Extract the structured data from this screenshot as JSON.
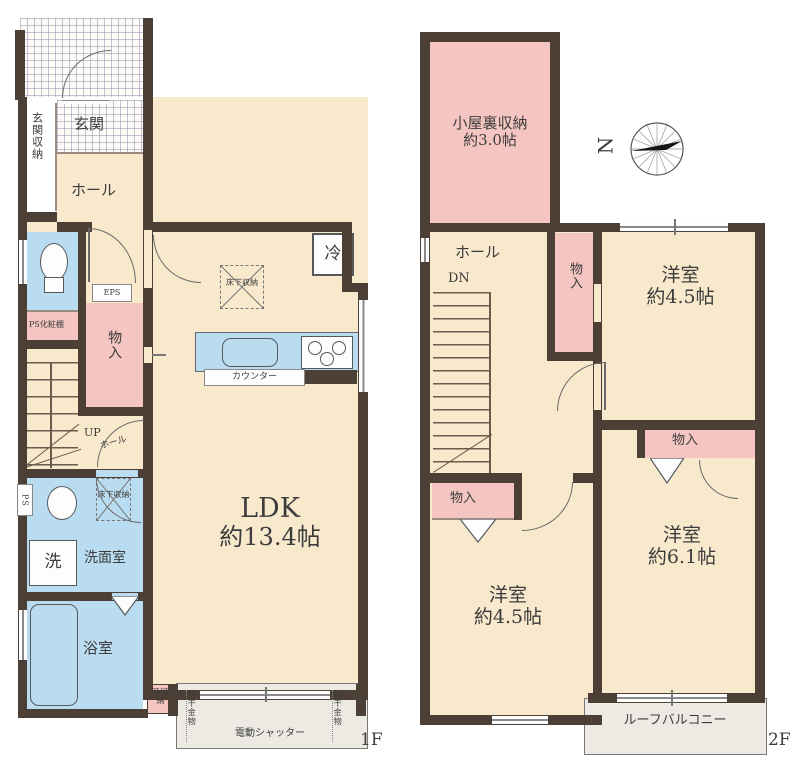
{
  "palette": {
    "wall": "#4c3f36",
    "beige": "#f8e9cd",
    "pink": "#f5c6c1",
    "blue": "#badcf0",
    "balcony_gray": "#edeae4"
  },
  "f1": {
    "floor_label": "1F",
    "genkan": "玄関",
    "genkan_storage": "玄関収納",
    "hall_upper": "ホール",
    "ps_shelf": "PS化粧棚",
    "eps": "EPS",
    "storage": "物入",
    "up": "UP",
    "hall_stair": "ホール",
    "fridge": "冷",
    "underfloor_ldk": "床下収納",
    "counter": "カウンター",
    "ldk_name": "LDK",
    "ldk_size": "約13.4帖",
    "ps": "PS",
    "underfloor_wash": "床下収納",
    "washroom": "洗面室",
    "washer": "洗",
    "bathroom": "浴室",
    "ev_storage": "EV収納",
    "laundry_left": "物干金物",
    "laundry_right": "物干金物",
    "shutter": "電動シャッター"
  },
  "f2": {
    "floor_label": "2F",
    "attic_name": "小屋裏収納",
    "attic_size": "約3.0帖",
    "hall": "ホール",
    "dn": "DN",
    "storage_hall": "物入",
    "room_a_name": "洋室",
    "room_a_size": "約4.5帖",
    "storage_b": "物入",
    "room_b_name": "洋室",
    "room_b_size": "約6.1帖",
    "storage_c": "物入",
    "room_c_name": "洋室",
    "room_c_size": "約4.5帖",
    "roof_balcony": "ルーフバルコニー"
  },
  "compass": {
    "north": "N"
  }
}
